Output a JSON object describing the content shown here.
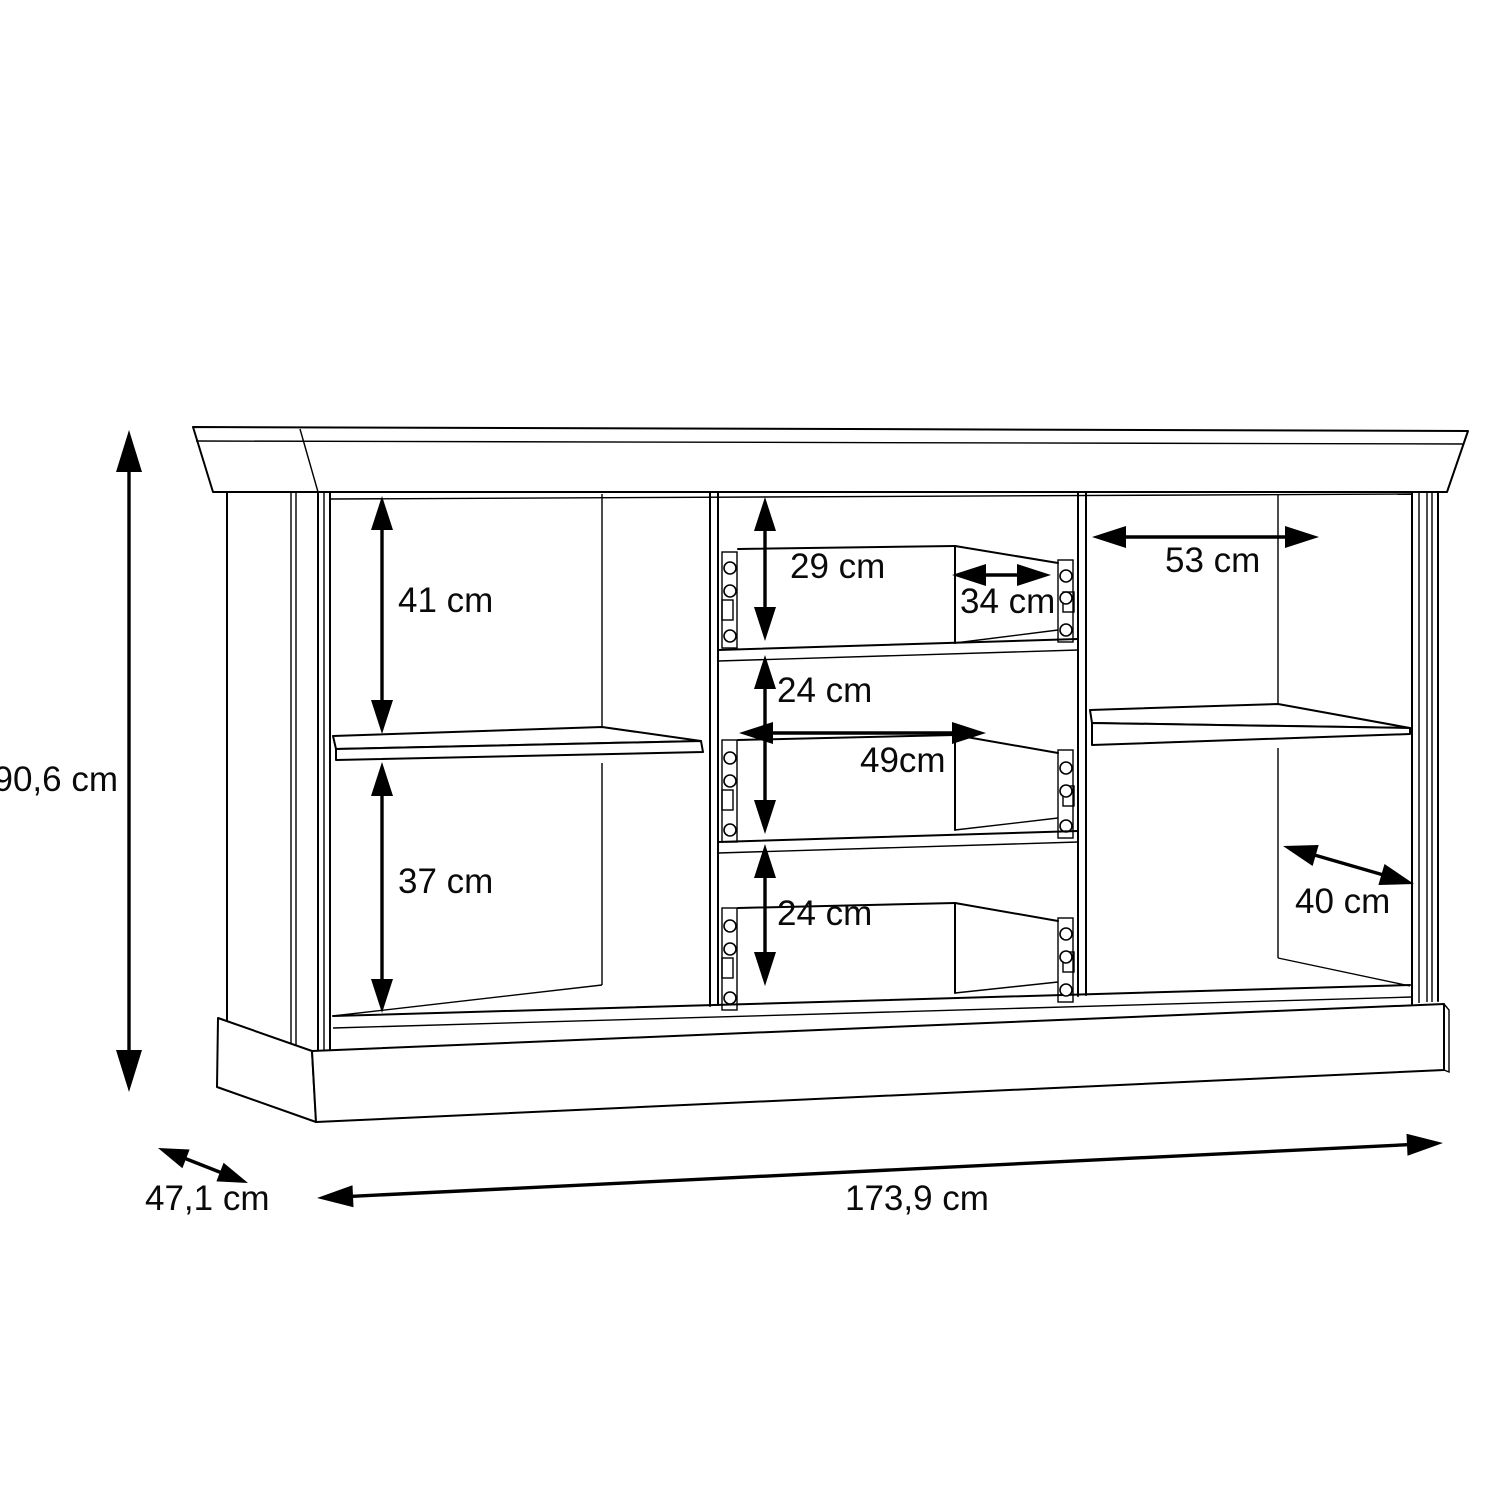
{
  "drawing": {
    "kind": "furniture-dimension-diagram",
    "subject": "sideboard carcass with two door compartments, one shelf per compartment and three centre drawers",
    "units": "cm",
    "background_color": "#ffffff",
    "line_color": "#000000",
    "overall": {
      "height": "90,6 cm",
      "depth": "47,1 cm",
      "width": "173,9 cm"
    },
    "labels": {
      "height": "90,6 cm",
      "depth": "47,1 cm",
      "width": "173,9 cm",
      "left_upper": "41 cm",
      "left_lower": "37 cm",
      "mid_top": "29 cm",
      "mid_drawer_width": "34 cm",
      "mid_middle": "24 cm",
      "mid_inner_width": "49cm",
      "mid_bottom": "24 cm",
      "right_upper_width": "53 cm",
      "right_lower_width": "40 cm"
    }
  }
}
